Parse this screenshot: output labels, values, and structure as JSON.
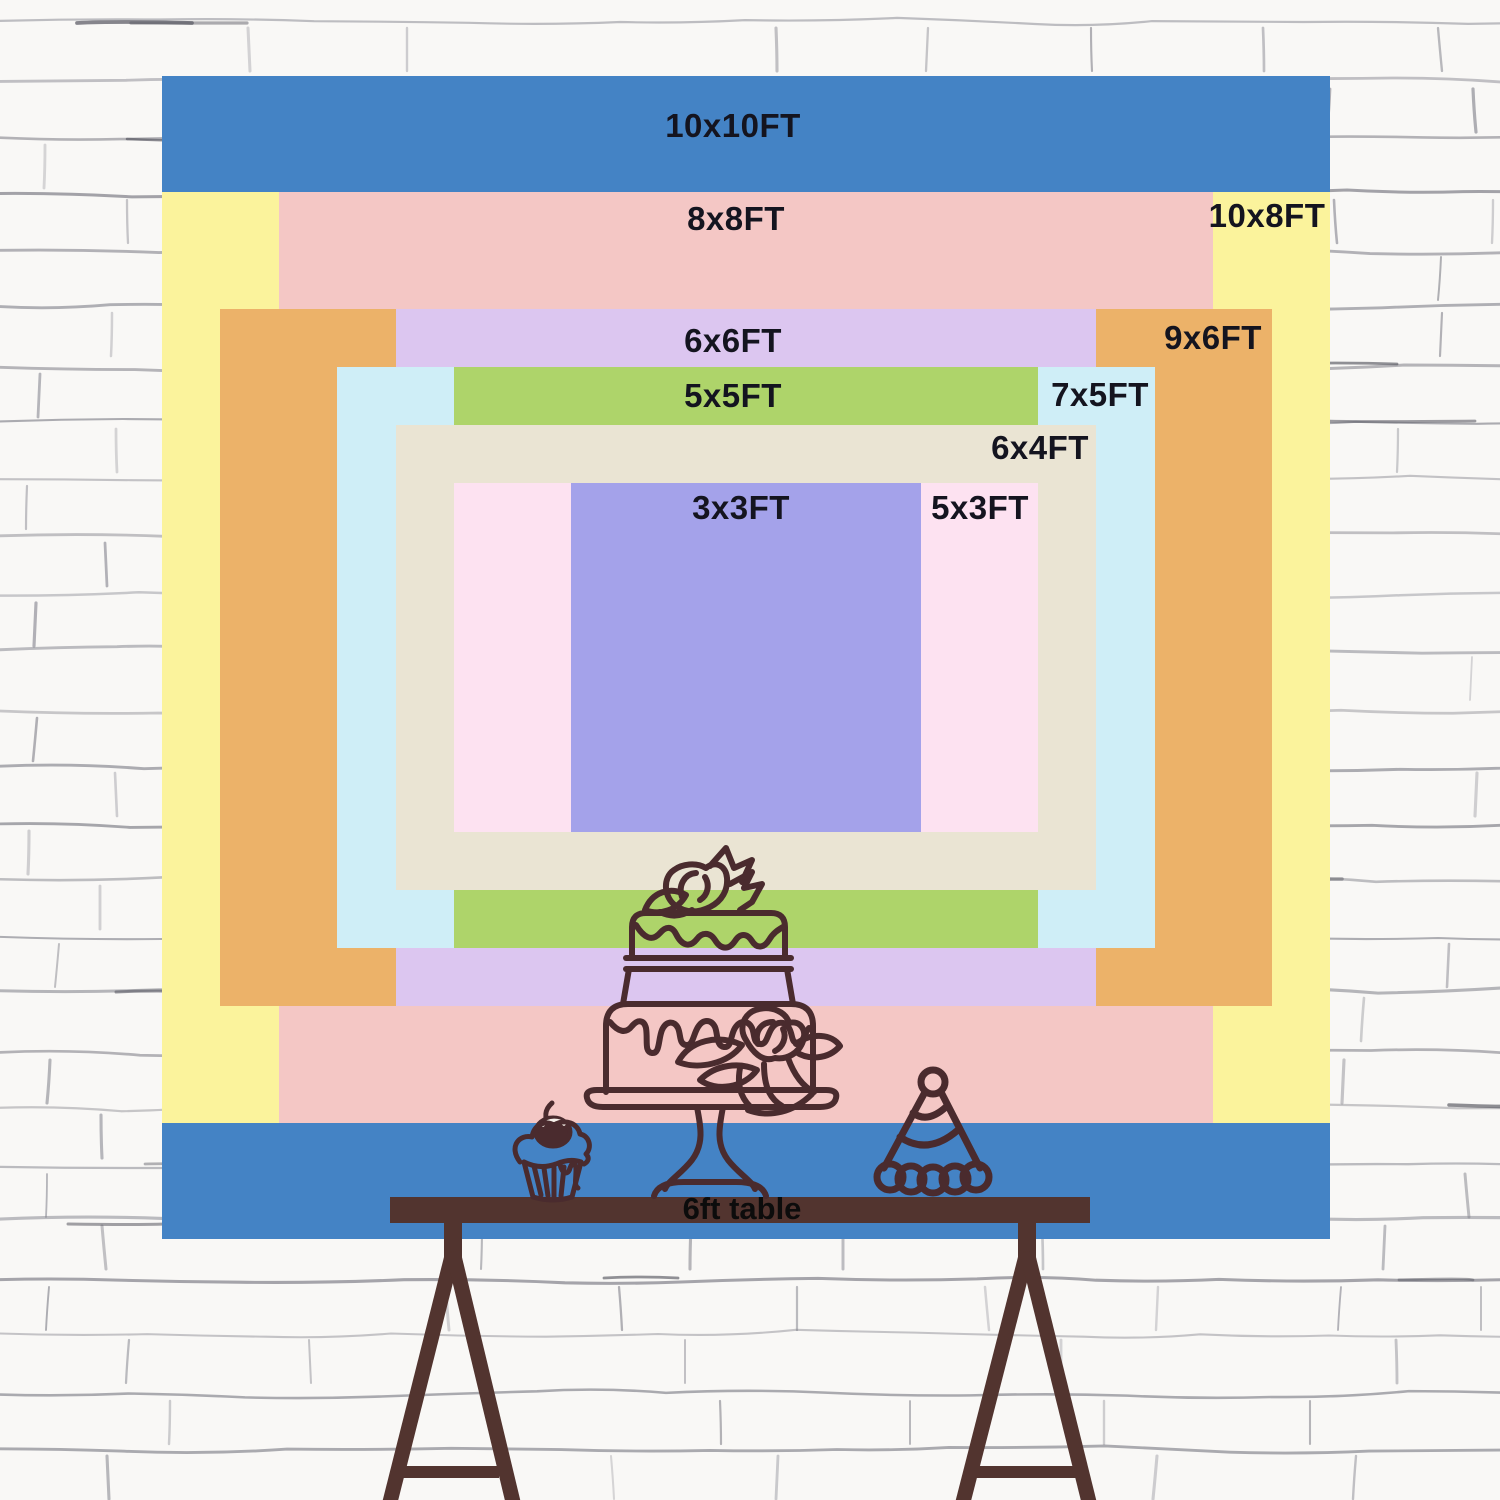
{
  "title": "backdrop size comparison chart",
  "colors": {
    "wall_bg": "#f9f8f6",
    "wall_line": "#83838c",
    "line_art": "#4a2b2e",
    "table_wood": "#52342f",
    "label_text": "#14141f"
  },
  "backdrop": {
    "origin_x": 162,
    "origin_y": 76,
    "width": 1168,
    "height": 1163,
    "full_ft": 10,
    "sizes": [
      {
        "id": "10x10",
        "label": "10x10FT",
        "w_ft": 10,
        "h_ft": 10,
        "color": "#4483c5",
        "label_x": 733,
        "label_y": 126
      },
      {
        "id": "10x8",
        "label": "10x8FT",
        "w_ft": 10,
        "h_ft": 8,
        "color": "#fbf39c",
        "label_x": 1267,
        "label_y": 216
      },
      {
        "id": "8x8",
        "label": "8x8FT",
        "w_ft": 8,
        "h_ft": 8,
        "color": "#f4c7c5",
        "label_x": 736,
        "label_y": 219
      },
      {
        "id": "9x6",
        "label": "9x6FT",
        "w_ft": 9,
        "h_ft": 6,
        "color": "#ecb269",
        "label_x": 1213,
        "label_y": 338
      },
      {
        "id": "6x6",
        "label": "6x6FT",
        "w_ft": 6,
        "h_ft": 6,
        "color": "#dcc6f0",
        "label_x": 733,
        "label_y": 341
      },
      {
        "id": "7x5",
        "label": "7x5FT",
        "w_ft": 7,
        "h_ft": 5,
        "color": "#cfeef7",
        "label_x": 1100,
        "label_y": 395
      },
      {
        "id": "5x5",
        "label": "5x5FT",
        "w_ft": 5,
        "h_ft": 5,
        "color": "#aed46a",
        "label_x": 733,
        "label_y": 396
      },
      {
        "id": "6x4",
        "label": "6x4FT",
        "w_ft": 6,
        "h_ft": 4,
        "color": "#eae4d3",
        "label_x": 1040,
        "label_y": 448
      },
      {
        "id": "5x3",
        "label": "5x3FT",
        "w_ft": 5,
        "h_ft": 3,
        "color": "#fde2f1",
        "label_x": 980,
        "label_y": 508
      },
      {
        "id": "3x3",
        "label": "3x3FT",
        "w_ft": 3,
        "h_ft": 3,
        "color": "#a4a2ea",
        "label_x": 741,
        "label_y": 508
      }
    ]
  },
  "table": {
    "label": "6ft table"
  },
  "icons": {
    "cake": "two-tier-cake-with-roses-line-art",
    "cupcake": "cupcake-with-cherry-line-art",
    "party_hat": "striped-party-hat-line-art",
    "trestle_legs": "a-frame-table-legs"
  }
}
